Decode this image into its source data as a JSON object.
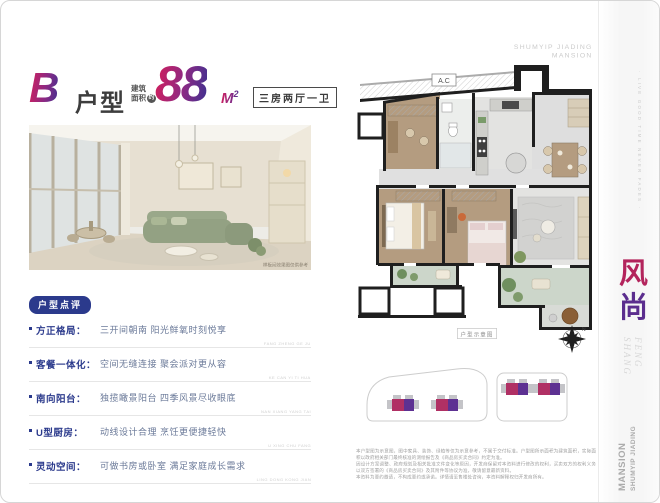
{
  "header": {
    "unit_letter": "B",
    "unit_word": "户型",
    "area_prefix_top": "建筑",
    "area_prefix_bottom": "面积",
    "approx_badge": "约",
    "area_value": "88",
    "area_unit": "M",
    "area_unit_sup": "2",
    "layout_tag": "三房两厅一卫"
  },
  "photo": {
    "caption": "样板间效果图仅供参考"
  },
  "review": {
    "badge": "户型点评",
    "items": [
      {
        "label": "方正格局：",
        "desc": "三开间朝南 阳光鲜氧时刻悦享",
        "note": "FANG ZHENG GE JU"
      },
      {
        "label": "客餐一体化：",
        "desc": "空间无缝连接 聚会派对更从容",
        "note": "KE CAN YI TI HUA"
      },
      {
        "label": "南向阳台：",
        "desc": "独揽瞰景阳台 四季风景尽收眼底",
        "note": "NAN XIANG YANG TAI"
      },
      {
        "label": "U型厨房：",
        "desc": "动线设计合理 烹饪更便捷轻快",
        "note": "U XING CHU FANG"
      },
      {
        "label": "灵动空间：",
        "desc": "可做书房或卧室 满足家庭成长需求",
        "note": "LING DONG KONG JIAN"
      }
    ]
  },
  "floorplan": {
    "ac_label": "A.C",
    "caption": "户型示意图",
    "compass_n": "N"
  },
  "brand": {
    "logo_line1": "SHUMYIP JIADING",
    "logo_line2": "MANSION",
    "side_tagline": "· LIVE GOOD TIME NEVER FADES ·",
    "cn_char_1": "风",
    "cn_char_2": "尚",
    "en_line1": "FENG",
    "en_line2": "SHANG",
    "bottom_brand_small": "SHUMYIP JIADING",
    "bottom_brand_big": "MANSION"
  },
  "disclaimer": {
    "lines": [
      "本户型图为示意图，图中家具、装饰、绿植等仅为示意参考，不属于交付标准。户型图所示面积为建筑面积，实际面积以政府相关部门最终核准的测绘报告及《商品房买卖合同》约定为准。",
      "因设计方案调整、政府规划及相关批准文件变化等原因，开发商保留对本资料进行修改的权利，买卖双方的权利义务以双方签署的《商品房买卖合同》及其附件等协议为准，敬请留意最新资料。",
      "本资料为要约邀请，不构成要约或承诺。详情请至售楼处咨询，本资料解释权归开发商所有。"
    ]
  },
  "colors": {
    "gradient_start": "#CF1F5E",
    "gradient_end": "#46308F",
    "navy": "#2B3A8C",
    "feng_red": "#B3245C",
    "shang_purple": "#5B2D8E",
    "unit_magenta": "#B03064",
    "unit_purple": "#5D3192"
  }
}
